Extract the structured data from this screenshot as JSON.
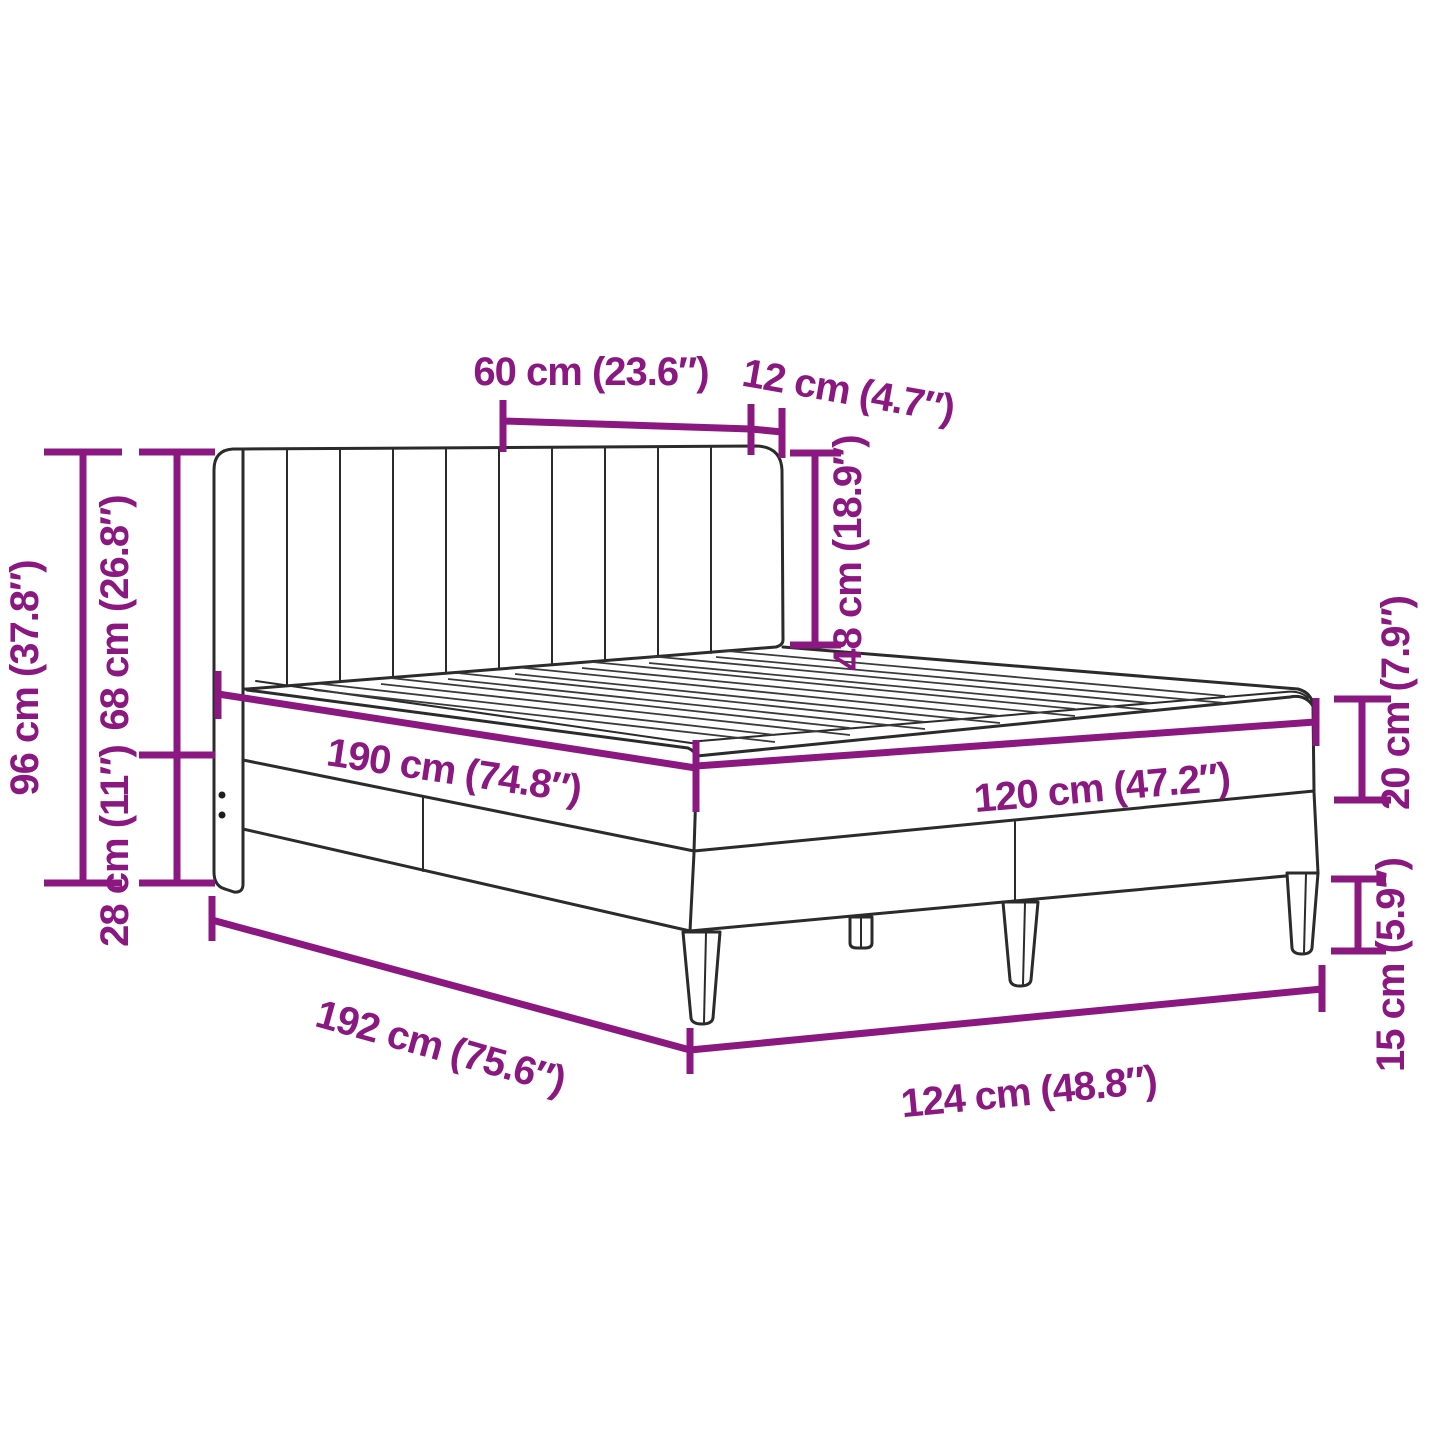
{
  "diagram": {
    "title": "Bed frame with headboard — dimensions diagram",
    "accent_color": "#8A1880",
    "line_color": "#2b2b2b",
    "background_color": "#ffffff",
    "dimensions": {
      "headboard_section_width": "60 cm (23.6″)",
      "headboard_wing_width": "12 cm (4.7″)",
      "headboard_above_mattress": "48 cm (18.9″)",
      "total_height": "96 cm (37.8″)",
      "headboard_height": "68 cm (26.8″)",
      "base_section_height": "28 cm (11″)",
      "mattress_length": "190 cm (74.8″)",
      "mattress_width": "120 cm (47.2″)",
      "mattress_thickness": "20 cm (7.9″)",
      "leg_height": "15 cm (5.9″)",
      "frame_length": "192 cm (75.6″)",
      "frame_width": "124 cm (48.8″)"
    }
  }
}
